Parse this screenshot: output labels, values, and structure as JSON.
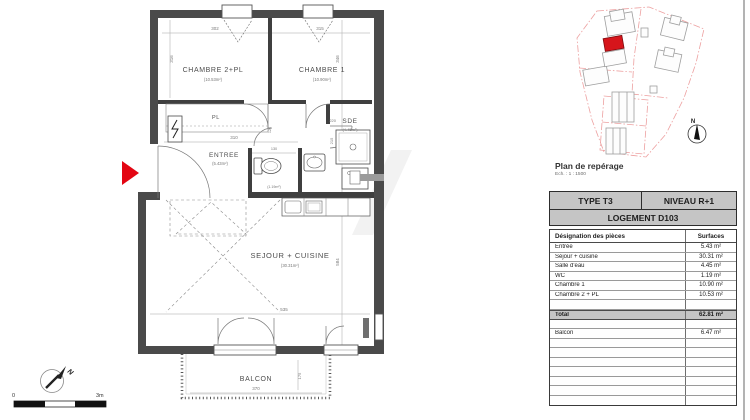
{
  "floor_plan": {
    "rooms": {
      "chambre2": {
        "name": "CHAMBRE 2+PL",
        "area": "(10.53m²)"
      },
      "chambre1": {
        "name": "CHAMBRE 1",
        "area": "(10.90m²)"
      },
      "entree": {
        "name": "ENTREE",
        "area": "(5.43m²)"
      },
      "sde": {
        "name": "SDE",
        "area": "(4.45m²)"
      },
      "wc": {
        "name": "WC",
        "area": "(1.19m²)"
      },
      "sejour": {
        "name": "SEJOUR + CUISINE",
        "area": "(30.31m²)"
      },
      "balcon": {
        "name": "BALCON"
      },
      "placard": {
        "name": "PL"
      }
    },
    "dimensions": {
      "chambre2_w": "302",
      "chambre1_w": "315",
      "chambre2_h": "316",
      "chambre1_h": "346",
      "entree_w": "310",
      "hall_w": "120",
      "wc_w": "130",
      "sde_w": "220",
      "sde_h": "215",
      "sejour_w": "535",
      "sejour_h": "584",
      "balcon_w": "370",
      "balcon_h": "175"
    },
    "north_label": "N"
  },
  "scale_bar": {
    "start": "0",
    "end": "3m"
  },
  "site_plan": {
    "caption": "Plan de repérage",
    "scale": "Ech. : 1 : 1500",
    "north_label": "N"
  },
  "surface_table": {
    "type": "TYPE T3",
    "niveau": "NIVEAU R+1",
    "logement": "LOGEMENT D103",
    "col_designation": "Désignation des pièces",
    "col_surfaces": "Surfaces",
    "rows": [
      {
        "label": "Entrée",
        "value": "5.43 m²"
      },
      {
        "label": "Séjour + cuisine",
        "value": "30.31 m²"
      },
      {
        "label": "Salle d'eau",
        "value": "4.45 m²"
      },
      {
        "label": "WC",
        "value": "1.19 m²"
      },
      {
        "label": "Chambre 1",
        "value": "10.90 m²"
      },
      {
        "label": "Chambre 2 + PL",
        "value": "10.53 m²"
      }
    ],
    "total_label": "Total",
    "total_value": "62.81 m²",
    "balcon_label": "Balcon",
    "balcon_value": "6.47 m²",
    "empty_trailing_rows": 7
  },
  "colors": {
    "wall": "#4a4a4a",
    "entrance_arrow_red": "#e30613",
    "site_highlight_red": "#d6151b",
    "table_header_bg": "#c5c5c5"
  }
}
